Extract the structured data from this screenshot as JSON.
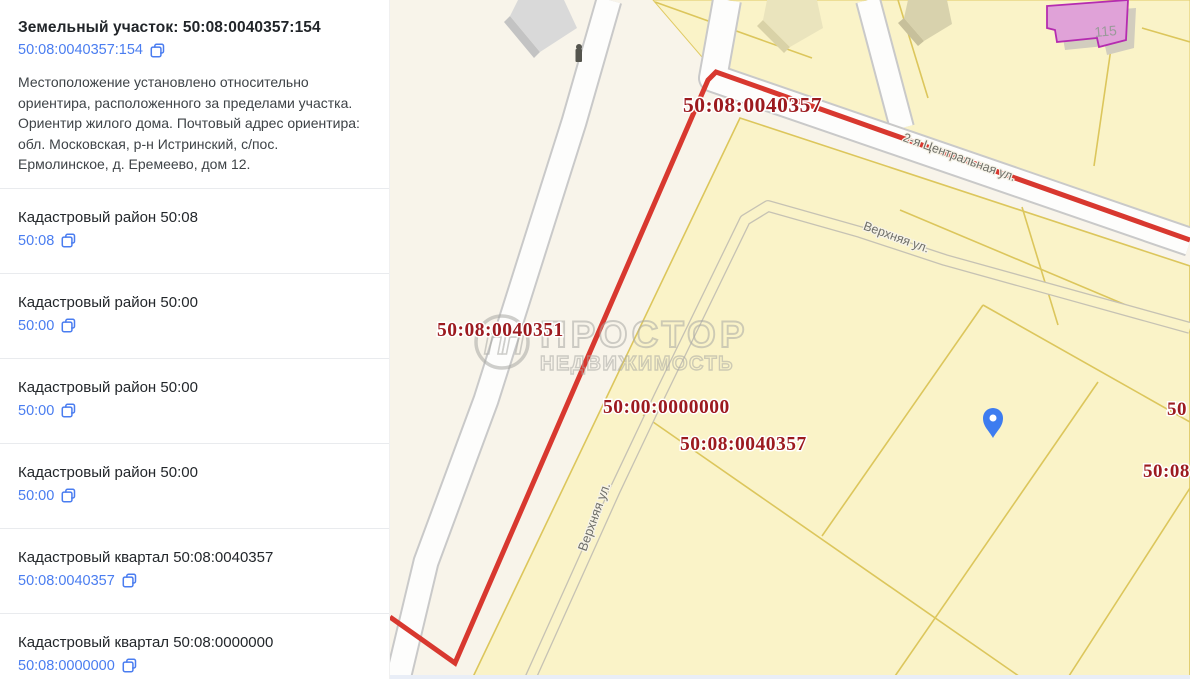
{
  "sidebar": {
    "parcel": {
      "title": "Земельный участок: 50:08:0040357:154",
      "code": "50:08:0040357:154",
      "description": "Местоположение установлено относительно ориентира, расположенного за пределами участка. Ориентир жилого дома. Почтовый адрес ориентира: обл. Московская, р-н Истринский, с/пос. Ермолинское, д. Еремеево, дом 12."
    },
    "sections": [
      {
        "title": "Кадастровый район 50:08",
        "code": "50:08"
      },
      {
        "title": "Кадастровый район 50:00",
        "code": "50:00"
      },
      {
        "title": "Кадастровый район 50:00",
        "code": "50:00"
      },
      {
        "title": "Кадастровый район 50:00",
        "code": "50:00"
      },
      {
        "title": "Кадастровый квартал 50:08:0040357",
        "code": "50:08:0040357"
      },
      {
        "title": "Кадастровый квартал 50:08:0000000",
        "code": "50:08:0000000"
      }
    ]
  },
  "map": {
    "labels": {
      "quarter_top": "50:08:0040357",
      "quarter_left": "50:08:0040351",
      "zone_center": "50:00:0000000",
      "quarter_center": "50:08:0040357",
      "edge_right_top": "50",
      "edge_right_bottom": "50:08",
      "building_number": "115"
    },
    "streets": {
      "central": "2-я Центральная ул.",
      "upper": "Верхняя ул."
    },
    "watermark": {
      "logo": "ПП",
      "line1": "ПРОСТОР",
      "line2": "НЕДВИЖИМОСТЬ"
    },
    "colors": {
      "boundary_red": "#d8382f",
      "label_red": "#9c1a1f",
      "parcel_yellow": "#faf3c8",
      "parcel_border": "#dcc65c",
      "map_background": "#f8f4ea",
      "link_blue": "#4a7df0",
      "pin_blue": "#3d7cf0",
      "building_pink": "#e0a2d8",
      "building_pink_border": "#b52cb0"
    }
  }
}
